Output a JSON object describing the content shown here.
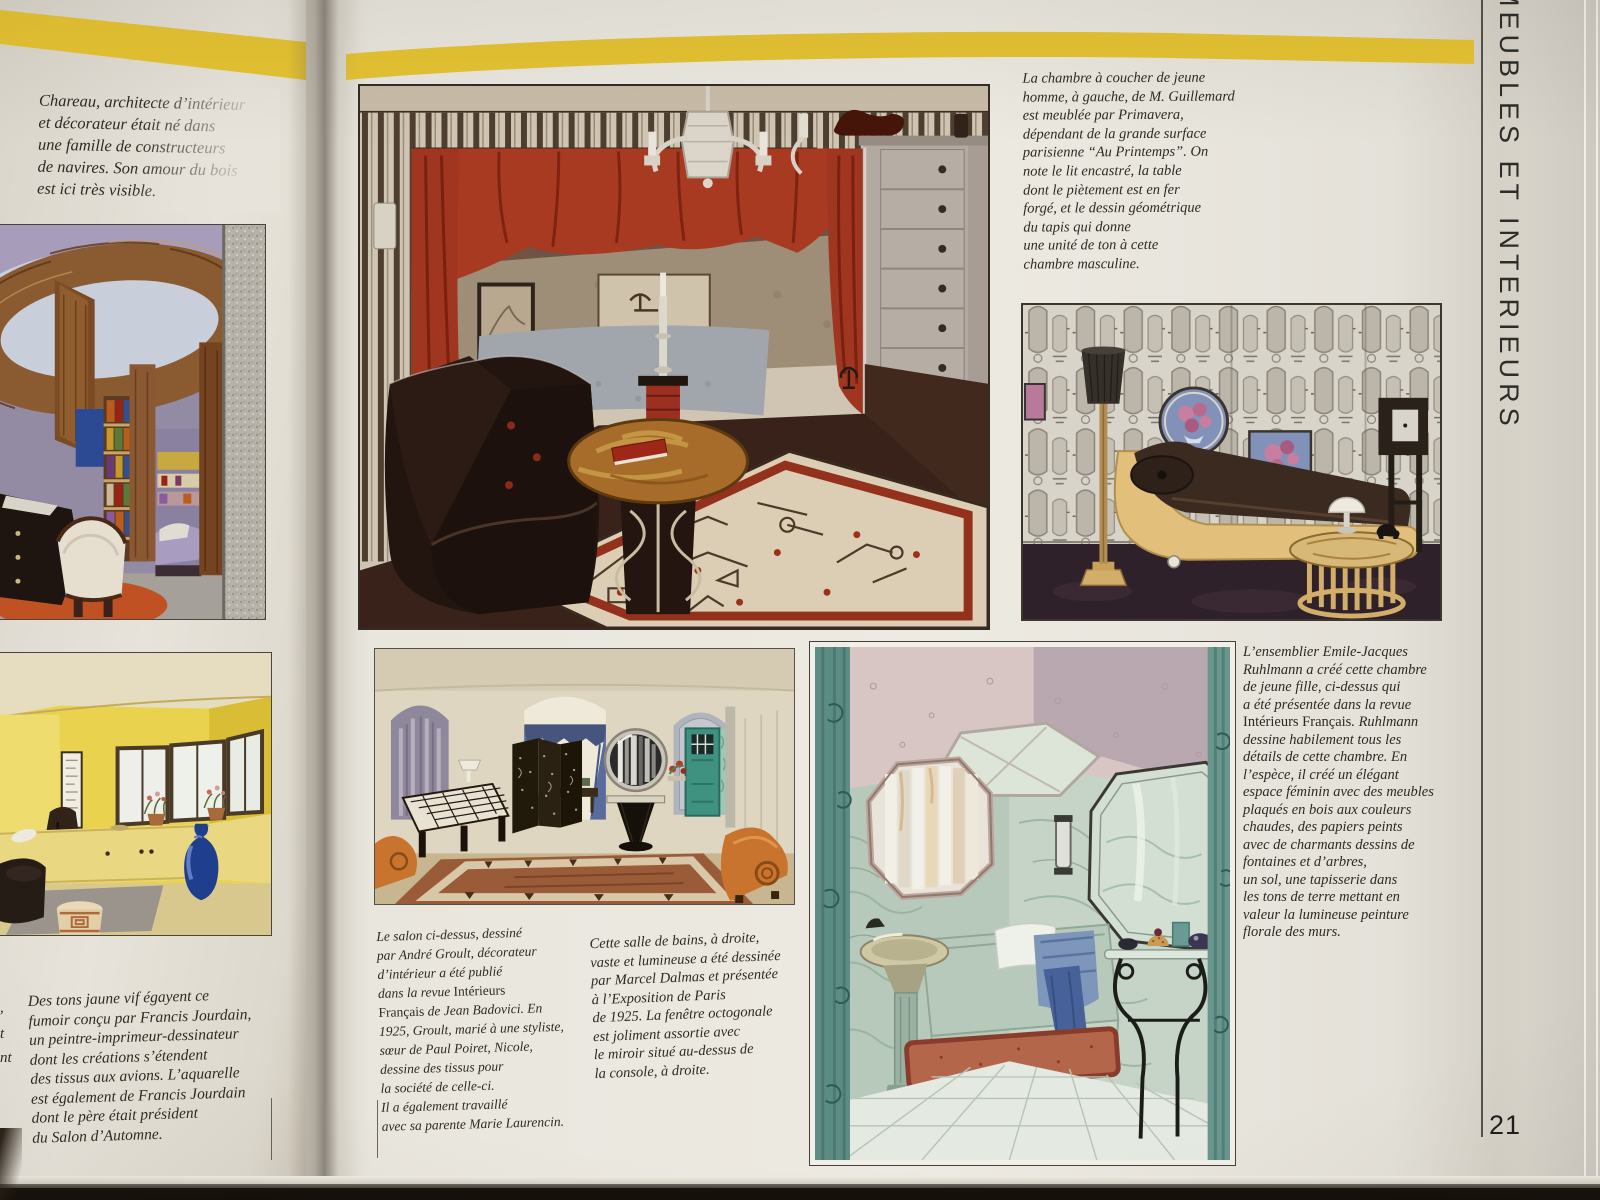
{
  "page": {
    "number": "21",
    "vertical_title": "MEUBLES ET INTERIEURS",
    "band_color": "#e5c332",
    "paper_color": "#ebe8e0",
    "ink_color": "#2e2a23"
  },
  "captions": {
    "chareau": "Chareau, architecte d’intérieur\net décorateur était né dans\nune famille de constructeurs\nde navires. Son amour du bois\nest ici très visible.",
    "guillemard": "La chambre à coucher de jeune\nhomme, à gauche, de M. Guillemard\nest meublée par Primavera,\ndépendant de la grande surface\nparisienne “Au Printemps”. On\nnote le lit encastré, la table\ndont le piètement est en fer\nforgé, et le dessin géométrique\ndu tapis qui donne\nune unité de ton à cette\nchambre masculine.",
    "ruhlmann": "L’ensemblier Emile-Jacques\nRuhlmann a créé cette chambre\nde jeune fille, ci-dessus qui\na été présentée dans la revue\nIntérieurs Français. Ruhlmann\ndessine habilement tous les\ndétails de cette chambre. En\nl’espèce, il créé un élégant\nespace féminin avec des meubles\nplaqués en bois aux couleurs\nchaudes, des papiers peints\navec de charmants dessins de\nfontaines et d’arbres,\nun sol, une tapisserie dans\nles tons de terre mettant en\nvaleur la lumineuse peinture\nflorale des murs.",
    "jourdain": "Des tons jaune vif égayent ce\nfumoir conçu par Francis Jourdain,\nun peintre-imprimeur-dessinateur\ndont les créations s’étendent\ndes tissus aux avions. L’aquarelle\nest également de Francis Jourdain\ndont le père était président\ndu Salon d’Automne.",
    "groult": "Le salon ci-dessus, dessiné\npar André Groult, décorateur\nd’intérieur a été publié\ndans la revue Intérieurs\nFrançais de Jean Badovici. En\n1925, Groult, marié à une styliste,\nsœur de Paul Poiret, Nicole,\ndessine des tissus pour\nla société de celle-ci.\nIl a également travaillé\navec sa parente Marie Laurencin.",
    "dalmas": "Cette salle de bains, à droite,\nvaste et lumineuse a été dessinée\npar Marcel Dalmas et présentée\nà l’Exposition de Paris\nde 1925. La fenêtre octogonale\nest joliment assortie avec\nle miroir situé au-dessus de\nla console, à droite."
  },
  "edge_fragments": {
    "f1": ",",
    "f2": "t",
    "f3": "nt"
  }
}
